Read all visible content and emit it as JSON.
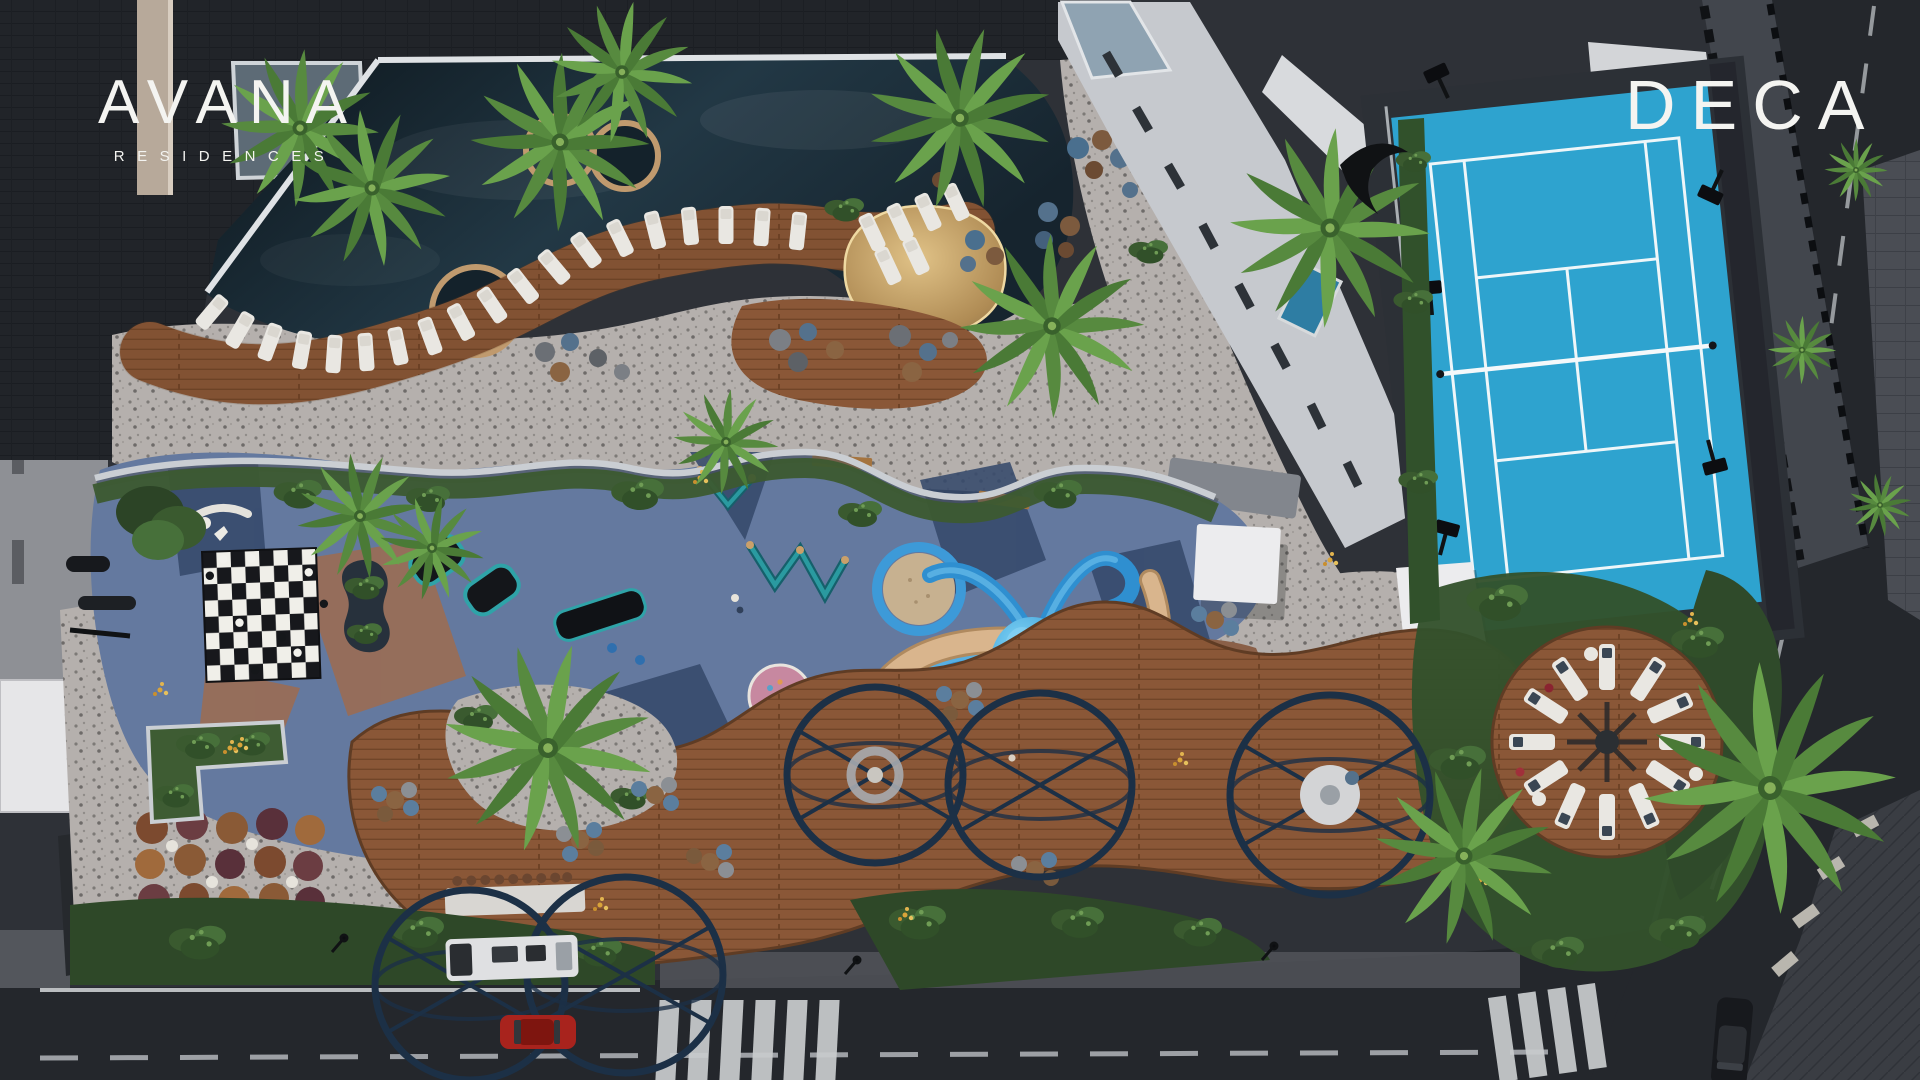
{
  "meta": {
    "width_px": 1920,
    "height_px": 1080,
    "view": "top-down dusk rendering of residential amenity deck"
  },
  "branding": {
    "avana_title": "AVANA",
    "avana_subtitle": "RESIDENCES",
    "deca_logo": "DECA"
  },
  "palette": {
    "roof_dark": "#212429",
    "water_dark": "#0c151b",
    "water_mid": "#223845",
    "deck_wood": "#8a5737",
    "deck_wood_dark": "#6f4326",
    "terrazzo": "#b5b0ad",
    "sand": "#c9a76b",
    "playground_blue": "#64799f",
    "playground_navy": "#35496b",
    "playground_clay": "#9c6c52",
    "court_blue": "#2ea3cf",
    "court_line": "#eef6f9",
    "octopus_blue": "#2f8fd0",
    "octopus_light": "#7fd0f4",
    "road_asphalt": "#24272c",
    "sidewalk": "#4a4d54",
    "greenery_dark": "#33512c",
    "greenery_light": "#578a3f",
    "lounger_white": "#e9e7e2",
    "pergola_steel": "#1c3046",
    "flower_yellow": "#d9a43a",
    "car_red": "#a8231d",
    "car_black": "#17191d",
    "truck_white": "#dfe0e2",
    "building_wing": "#c6c9ce",
    "cabana_white": "#ececee"
  }
}
